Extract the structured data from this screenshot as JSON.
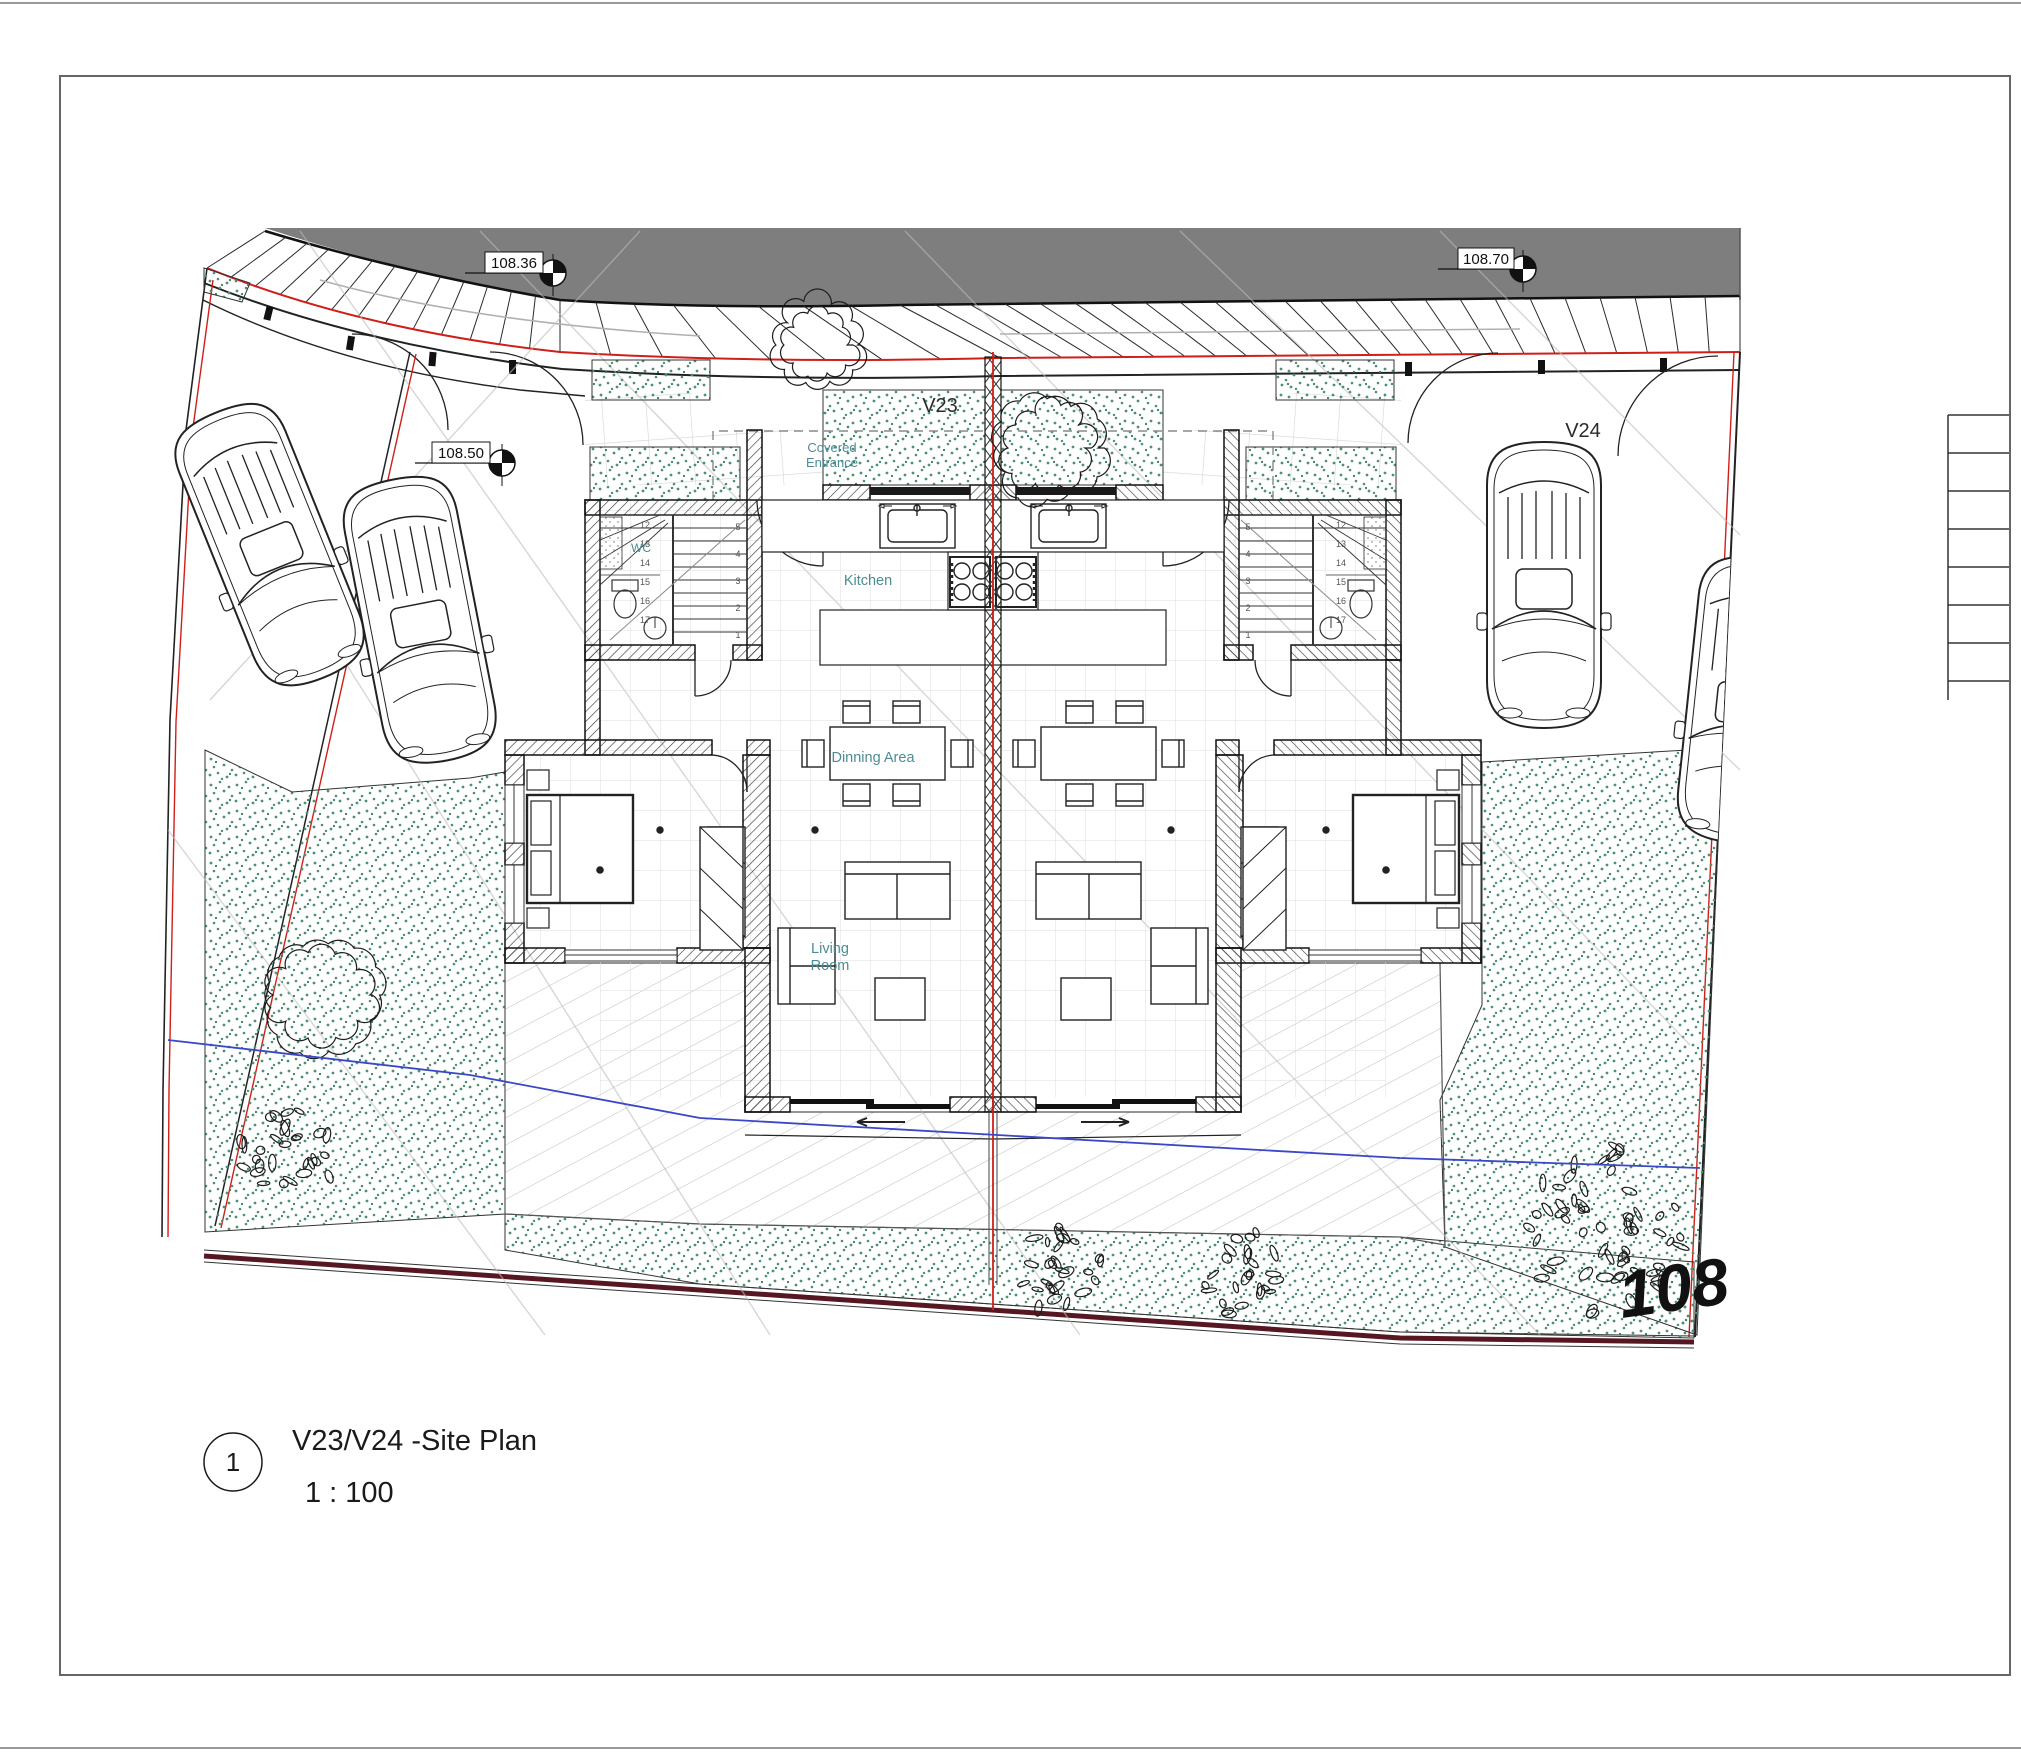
{
  "drawing": {
    "units": {
      "left_label": "V23",
      "right_label": "V24"
    },
    "rooms": {
      "covered_entrance": {
        "line1": "Covered",
        "line2": "Entrance"
      },
      "kitchen": "Kitchen",
      "dinning_area": "Dinning Area",
      "living_room": {
        "line1": "Living",
        "line2": "Room"
      },
      "wc": "WC"
    },
    "spot_elevations": [
      {
        "value": "108.36"
      },
      {
        "value": "108.70"
      },
      {
        "value": "108.50"
      }
    ],
    "contour_big_label": "108",
    "stairs": {
      "run_a": [
        "5",
        "4",
        "3",
        "2",
        "1"
      ],
      "run_b": [
        "12",
        "13",
        "14",
        "15",
        "16",
        "17"
      ]
    }
  },
  "title_block": {
    "view_number": "1",
    "view_name": "V23/V24 -Site Plan",
    "view_scale": "1 : 100"
  },
  "colors": {
    "road_gray": "#7e7e7e",
    "boundary_red": "#cf1f1a",
    "bottom_boundary_maroon": "#571722",
    "contour_blue": "#3947c8",
    "label_teal": "#4d8c94",
    "planting_green": "#4d9173"
  }
}
